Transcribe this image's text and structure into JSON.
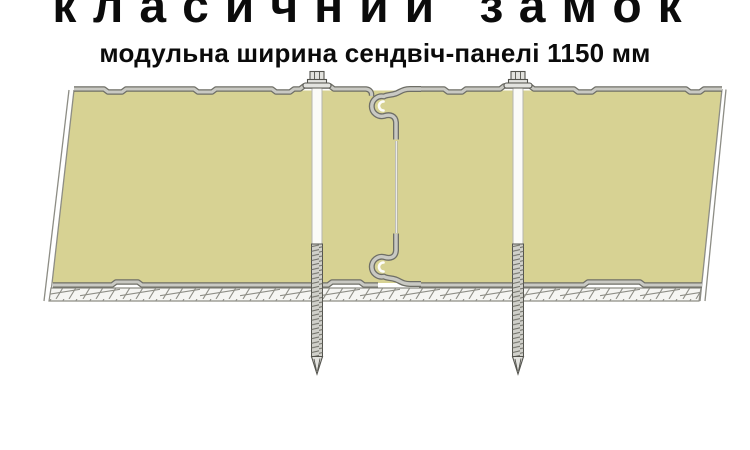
{
  "header": {
    "title": "класичний замок",
    "subtitle": "модульна ширина сендвіч-панелі 1150 мм"
  },
  "diagram": {
    "kind": "sandwich-panel classic tongue-and-groove lock, cross-section",
    "parts": [
      "panel-left",
      "panel-right",
      "lock-joint-top",
      "lock-joint-bottom",
      "panel-seam",
      "screw-left",
      "screw-right",
      "substructure-hatch"
    ],
    "colors": {
      "background": "#ffffff",
      "text": "#0b0b0b",
      "panel_core": "#d7d293",
      "facing_dark": "#6e6e66",
      "facing_light": "#c9c9c3",
      "metal_light": "#e3e3df",
      "screw_body": "#d0d0ca",
      "screw_shaft": "#fbfbf8",
      "shaft_edge": "#b5b5af",
      "outline": "#54544e",
      "hatch_bg": "#f5f5f2",
      "hatch_line": "#8d8d85",
      "seam_dark": "#a9a9a1",
      "seam_light": "#f2f2ee"
    }
  }
}
